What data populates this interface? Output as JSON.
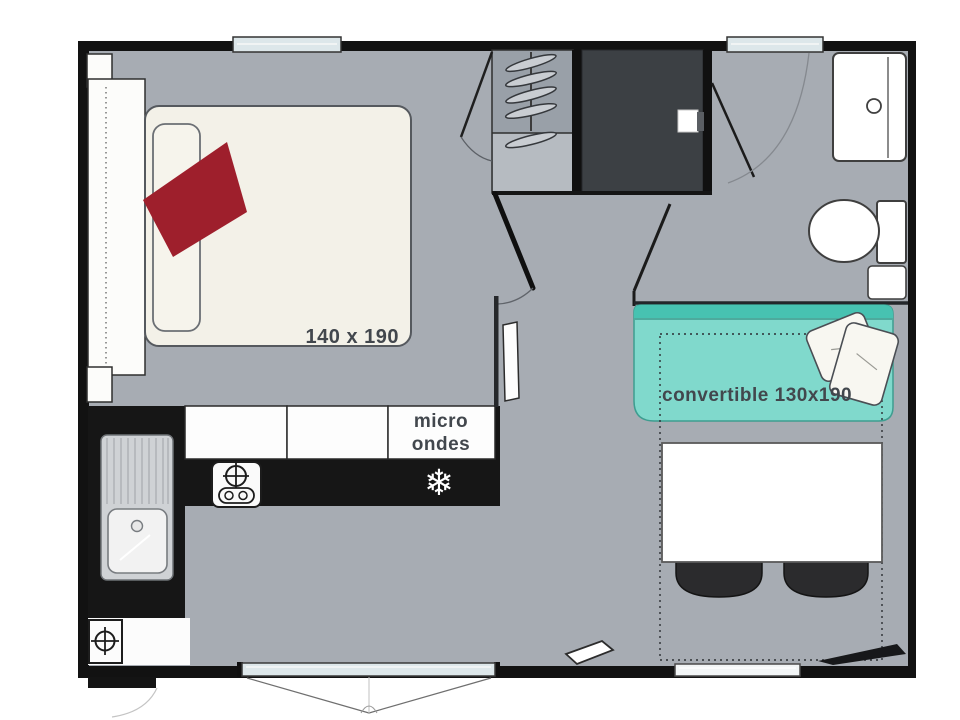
{
  "plan": {
    "title": "mobile-home floor plan",
    "bedroom": {
      "bed_label": "140 x 190"
    },
    "kitchen": {
      "microwave_label_line1": "micro",
      "microwave_label_line2": "ondes",
      "freezer_icon_glyph": "❄"
    },
    "living": {
      "sofa_label": "convertible 130x190"
    }
  },
  "colors": {
    "wall": "#121212",
    "floor": "#a7acb3",
    "counter": "#161616",
    "shower": "#3c4044",
    "wardrobe_top": "#99a0a8",
    "wardrobe_bottom": "#b6bbc1",
    "bed": "#f3f1e8",
    "quilt_red": "#9e1f2c",
    "sofa_teal": "#80d9cc",
    "sofa_teal_dark": "#47c2b1",
    "glass": "#dde7ea",
    "chair_dark": "#2b2b2d",
    "white_furniture": "#ffffff"
  }
}
